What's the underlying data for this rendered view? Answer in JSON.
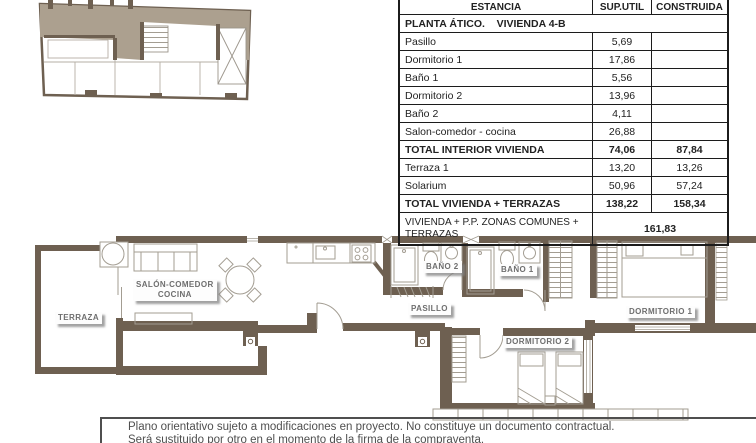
{
  "colors": {
    "wall_brown": "#6e6051",
    "key_plan_fill": "#aca08f",
    "furniture_line": "#a39d92",
    "label_text": "#6e6e6e",
    "table_border": "#1c1c1c"
  },
  "table": {
    "col_headers": {
      "estancia": "ESTANCIA",
      "sup_util": "SUP.UTIL",
      "construida": "CONSTRUIDA"
    },
    "section_title": "PLANTA ÁTICO.    VIVIENDA 4-B",
    "rows": [
      {
        "label": "Pasillo",
        "util": "5,69",
        "cons": ""
      },
      {
        "label": "Dormitorio 1",
        "util": "17,86",
        "cons": ""
      },
      {
        "label": "Baño 1",
        "util": "5,56",
        "cons": ""
      },
      {
        "label": "Dormitorio 2",
        "util": "13,96",
        "cons": ""
      },
      {
        "label": "Baño 2",
        "util": "4,11",
        "cons": ""
      },
      {
        "label": "Salon-comedor - cocina",
        "util": "26,88",
        "cons": ""
      },
      {
        "label": "TOTAL INTERIOR VIVIENDA",
        "util": "74,06",
        "cons": "87,84"
      },
      {
        "label": "Terraza 1",
        "util": "13,20",
        "cons": "13,26"
      },
      {
        "label": "Solarium",
        "util": "50,96",
        "cons": "57,24"
      },
      {
        "label": "TOTAL VIVIENDA + TERRAZAS",
        "util": "138,22",
        "cons": "158,34"
      }
    ],
    "summary_row": {
      "label": "VIVIENDA + P.P. ZONAS COMUNES + TERRAZAS",
      "value": "161,83"
    }
  },
  "plan_labels": {
    "terraza": "TERRAZA",
    "salon_line1": "SALÓN-COMEDOR",
    "salon_line2": "COCINA",
    "pasillo": "PASILLO",
    "bano2": "BAÑO 2",
    "bano1": "BAÑO 1",
    "dorm1": "DORMITORIO 1",
    "dorm2": "DORMITORIO 2"
  },
  "disclaimer": {
    "line1": "Plano orientativo sujeto a modificaciones en proyecto. No constituye un documento contractual.",
    "line2": "Será sustituido por otro en el momento de la firma de la compraventa."
  }
}
